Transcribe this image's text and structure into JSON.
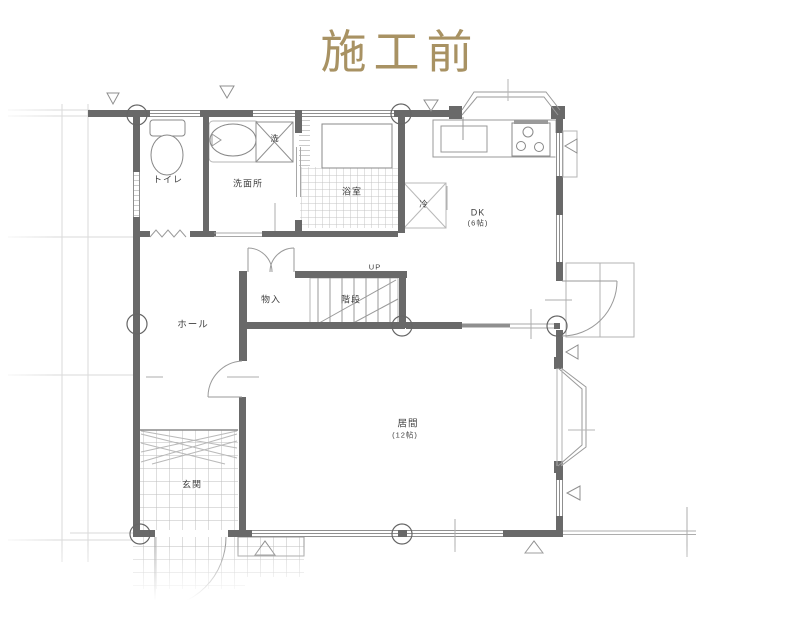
{
  "title": {
    "text": "施工前",
    "color": "#a89263"
  },
  "plan": {
    "labels": {
      "toilet": "トイレ",
      "washroom": "洗面所",
      "washer": "洗",
      "bathroom": "浴室",
      "fridge": "冷",
      "dk": "DK",
      "dk_size": "(6帖)",
      "closet": "物入",
      "stairs": "階段",
      "up": "UP",
      "hall": "ホール",
      "entrance": "玄関",
      "living": "居間",
      "living_size": "(12帖)"
    },
    "palette": {
      "wall": "#696969",
      "line": "#8f8f8f",
      "tile": "#c4c4c4",
      "faint": "#d9d9d9"
    }
  }
}
